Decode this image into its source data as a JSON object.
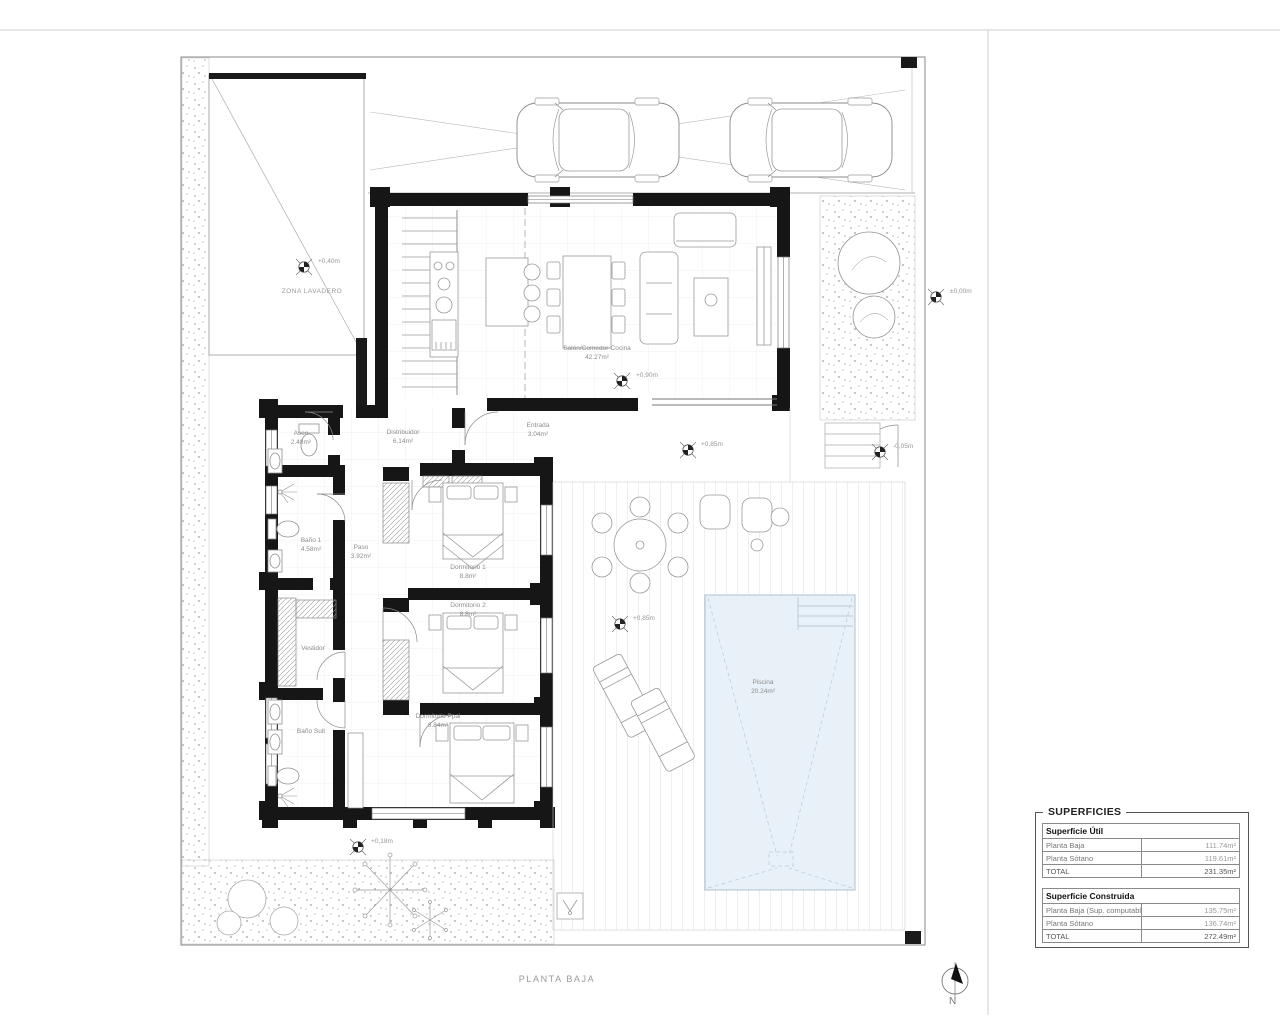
{
  "page": {
    "title": "PLANTA BAJA",
    "north_label": "N"
  },
  "zones": {
    "lavadero": "ZONA LAVADERO"
  },
  "rooms": {
    "salon": {
      "name": "Salón/Comedor-Cocina",
      "area": "42.27m²"
    },
    "distribuidor": {
      "name": "Distribuidor",
      "area": "6.14m²"
    },
    "entrada": {
      "name": "Entrada",
      "area": "3.04m²"
    },
    "aseo": {
      "name": "Aseo",
      "area": "2.48m²"
    },
    "banio1": {
      "name": "Baño 1",
      "area": "4.58m²"
    },
    "paso": {
      "name": "Paso",
      "area": "3.92m²"
    },
    "dormitorio1": {
      "name": "Dormitorio 1",
      "area": "8.8m²"
    },
    "dormitorio2": {
      "name": "Dormitorio 2",
      "area": "8.8m²"
    },
    "vestidor": {
      "name": "Vestidor",
      "area": ""
    },
    "banio_suit": {
      "name": "Baño Suit",
      "area": ""
    },
    "dormitorio_ppal": {
      "name": "Dormitorio Ppal",
      "area": "8.84m²"
    },
    "piscina": {
      "name": "Piscina",
      "area": "20.24m²"
    }
  },
  "levels": [
    "+0,40m",
    "±0,00m",
    "+0,90m",
    "+0,85m",
    "-0,05m",
    "+0,85m",
    "+0,18m"
  ],
  "superficies": {
    "box_title": "SUPERFICIES",
    "util": {
      "header": "Superficie Útil",
      "rows": [
        {
          "label": "Planta Baja",
          "value": "111.74m²"
        },
        {
          "label": "Planta Sótano",
          "value": "119.61m²"
        },
        {
          "label": "TOTAL",
          "value": "231.35m²"
        }
      ]
    },
    "construida": {
      "header": "Superficie Construida",
      "rows": [
        {
          "label": "Planta Baja (Sup. computable)",
          "value": "135.75m²"
        },
        {
          "label": "Planta Sótano",
          "value": "136.74m²"
        },
        {
          "label": "TOTAL",
          "value": "272.49m²"
        }
      ]
    }
  }
}
